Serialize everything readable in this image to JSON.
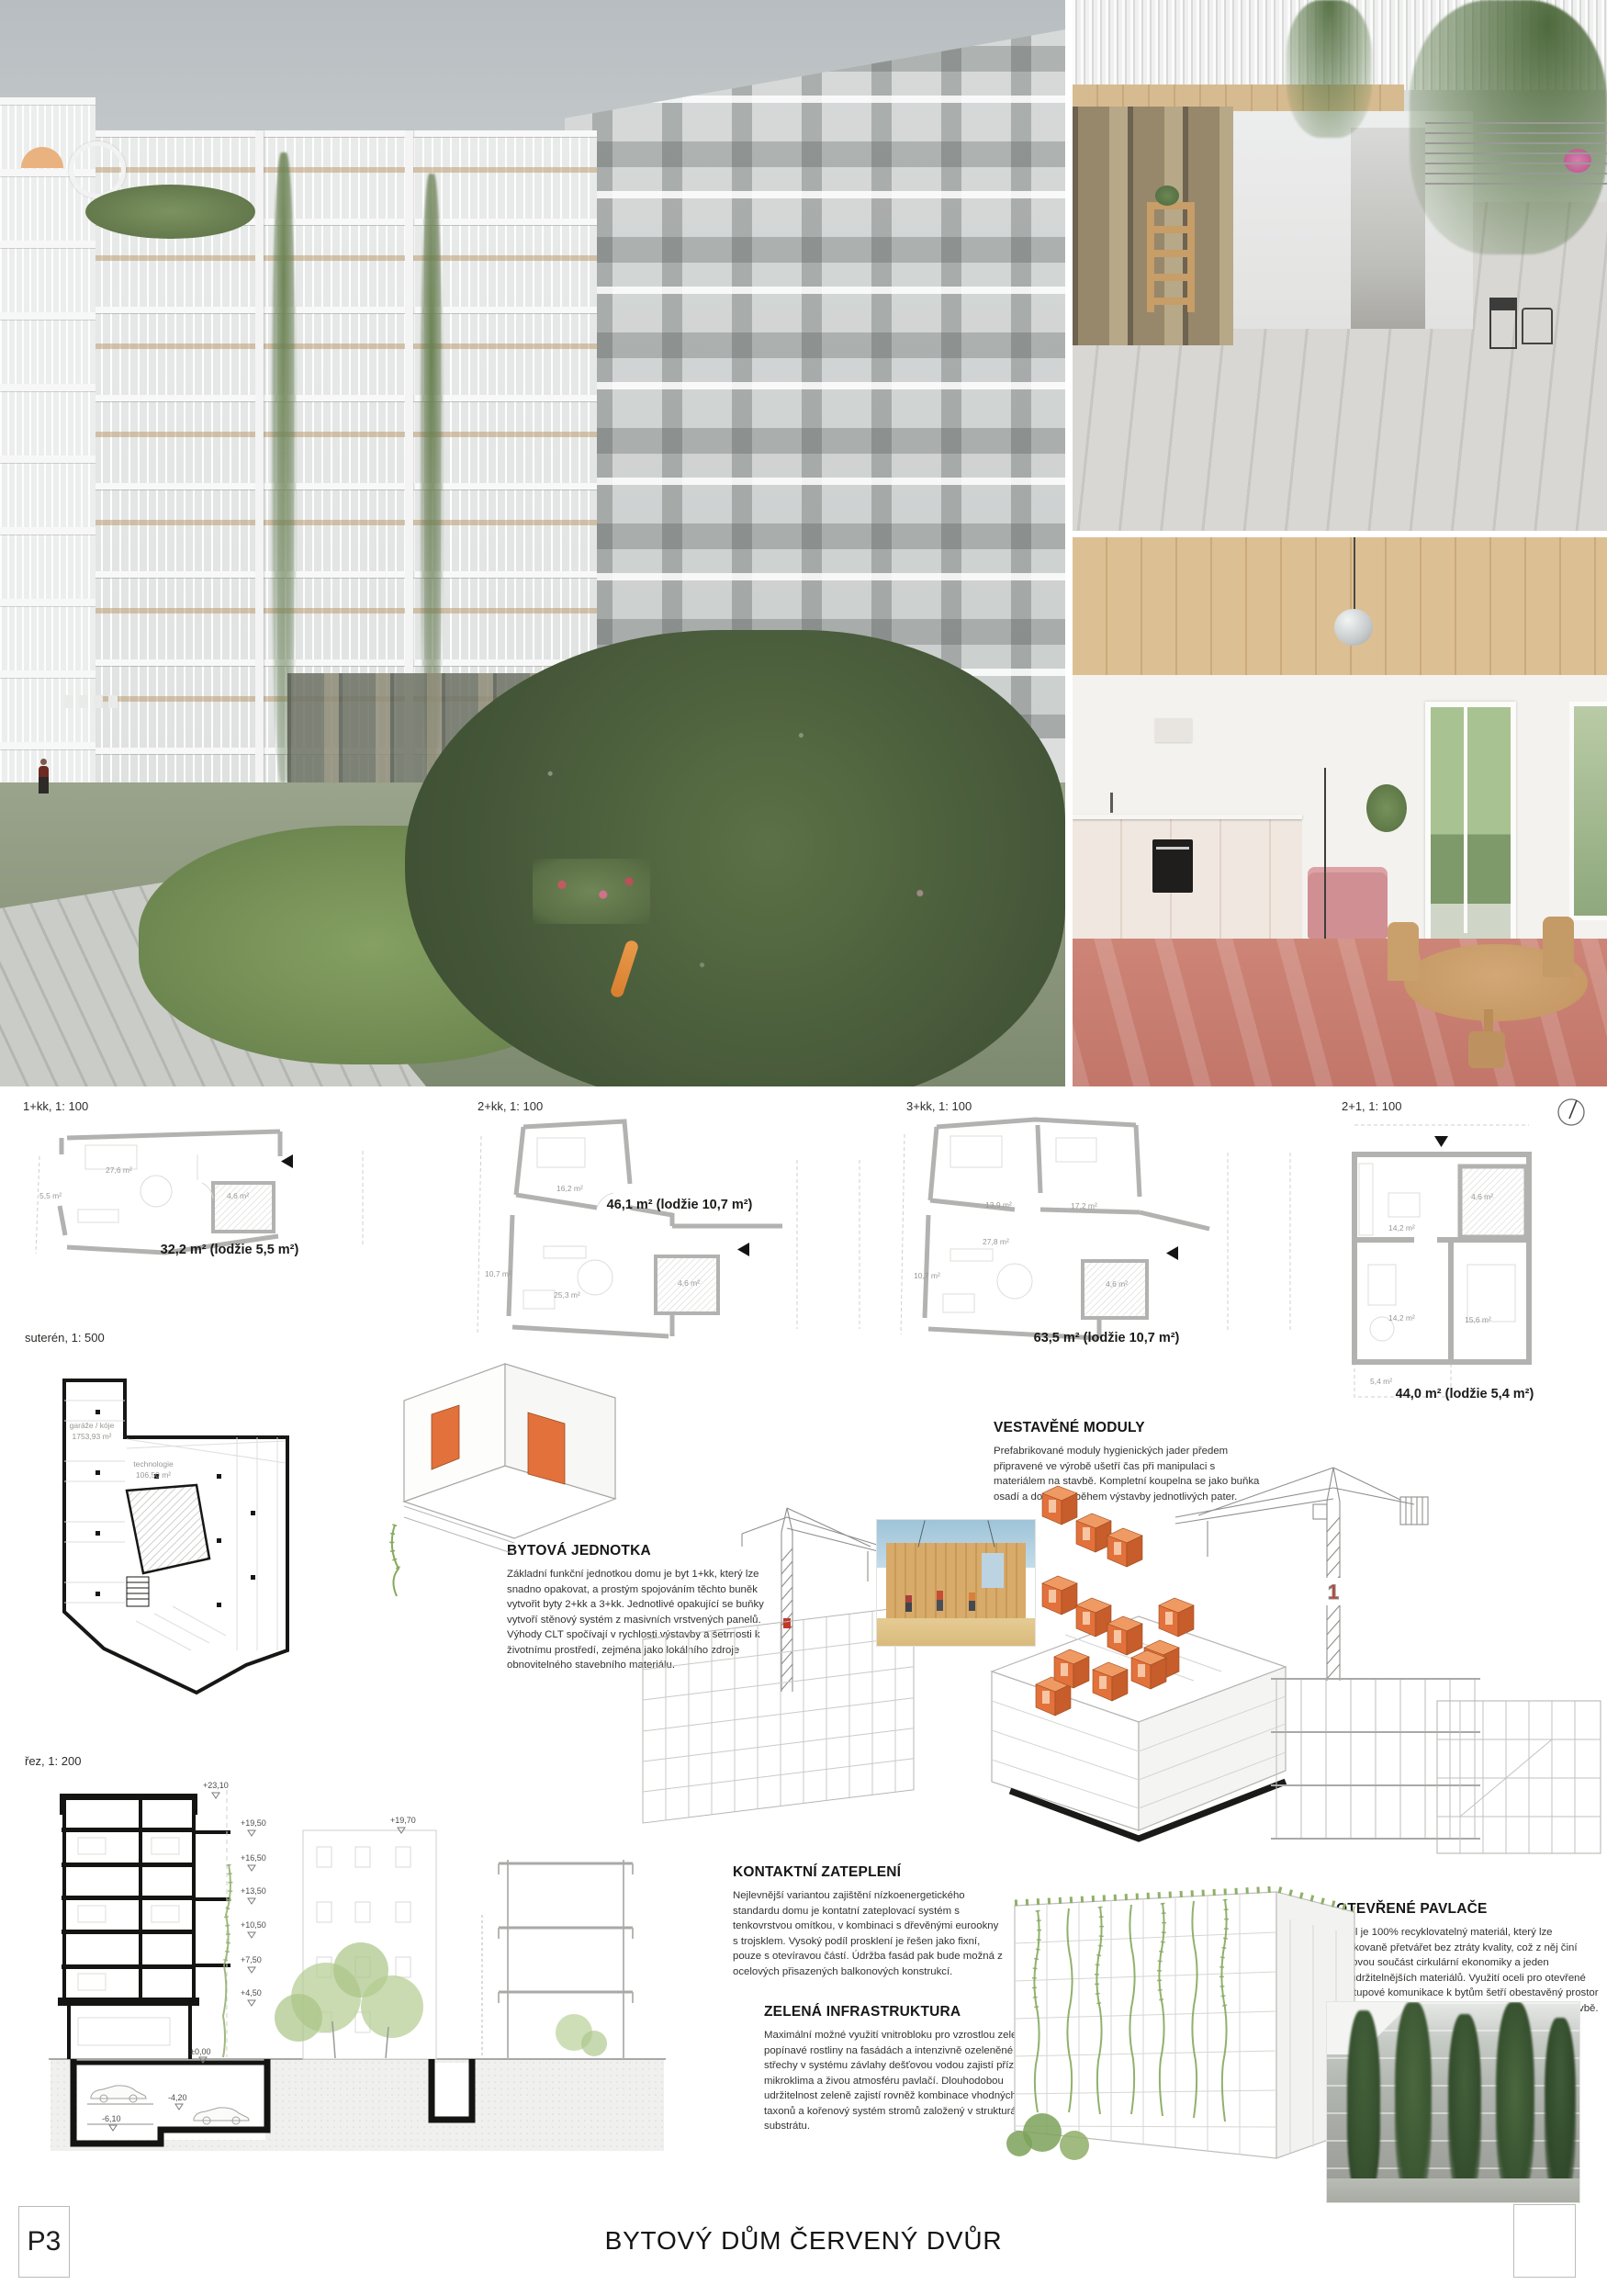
{
  "plans": [
    {
      "label": "1+kk, 1: 100",
      "caption": "32,2 m² (lodžie 5,5 m²)",
      "rooms": [
        "27,6 m²",
        "5,5 m²",
        "4,6 m²"
      ]
    },
    {
      "label": "2+kk, 1: 100",
      "caption": "46,1 m² (lodžie 10,7 m²)",
      "rooms": [
        "16,2 m²",
        "10,7 m²",
        "25,3 m²",
        "4,6 m²"
      ]
    },
    {
      "label": "3+kk, 1: 100",
      "caption": "63,5 m² (lodžie 10,7 m²)",
      "rooms": [
        "13,9 m²",
        "17,2 m²",
        "27,8 m²",
        "10,7 m²",
        "4,6 m²"
      ]
    },
    {
      "label": "2+1, 1: 100",
      "caption": "44,0 m² (lodžie 5,4 m²)",
      "rooms": [
        "14,2 m²",
        "4,6 m²",
        "14,2 m²",
        "15,6 m²",
        "5,4 m²"
      ]
    }
  ],
  "basement": {
    "label": "suterén, 1: 500",
    "garage_name": "garáže / kóje",
    "garage_area": "1753,93 m²",
    "tech_name": "technologie",
    "tech_area": "106,50 m²"
  },
  "section": {
    "label": "řez, 1: 200",
    "top_level": "+23,10",
    "levels": [
      "+19,50",
      "+16,50",
      "+13,50",
      "+10,50",
      "+7,50",
      "+4,50"
    ],
    "neighbor_level": "+19,70",
    "ground": "±0,00",
    "garage_levels": [
      "-4,20",
      "-6,10"
    ]
  },
  "blocks": {
    "bytova_jednotka": {
      "title": "BYTOVÁ JEDNOTKA",
      "body": "Základní funkční jednotkou domu je byt 1+kk, který lze snadno opakovat, a prostým spojováním těchto buněk vytvořit byty 2+kk a 3+kk. Jednotlivé opakující se buňky vytvoří stěnový systém z masivních vrstvených panelů. Výhody CLT spočívají v rychlosti výstavby a šetrnosti k životnímu prostředí, zejména jako lokálního zdroje obnovitelného stavebního materiálu."
    },
    "vestavene_moduly": {
      "title": "VESTAVĚNÉ MODULY",
      "body": "Prefabrikované moduly hygienických jader předem připravené ve výrobě ušetří čas při manipulaci s materiálem na stavbě. Kompletní koupelna se jako buňka osadí a dopojí již během výstavby jednotlivých pater."
    },
    "kontaktni_zatepleni": {
      "title": "KONTAKTNÍ ZATEPLENÍ",
      "body": "Nejlevnější variantou zajištění nízkoenergetického standardu domu je kontatní zateplovací systém s tenkovrstvou omítkou, v kombinaci s dřevěnými eurookny s trojsklem. Vysoký podíl prosklení je řešen jako fixní, pouze s otevíravou částí. Údržba fasád pak bude možná z ocelových přisazených balkonových konstrukcí."
    },
    "zelena_infrastruktura": {
      "title": "ZELENÁ INFRASTRUKTURA",
      "body": "Maximální možné využití vnitrobloku pro vzrostlou zeleň, popínavé rostliny na fasádách a intenzivně ozeleněné střechy v systému závlahy dešťovou vodou zajistí příznivé mikroklima a živou atmosféru pavlačí. Dlouhodobou udržitelnost zeleně zajistí rovněž kombinace vhodných taxonů a kořenový systém stromů založený v strukturálním substrátu."
    },
    "otevrene_pavlace": {
      "title": "OTEVŘENÉ PAVLAČE",
      "body": "Ocel je 100% recyklovatelný materiál, který lze opakovaně přetvářet bez ztráty kvality, což z něj činí klíčovou součást cirkulární ekonomiky a jeden nejudržitelnějších materiálů. Využití oceli pro otevřené přístupové komunikace k bytům šetří obestavěný prostor a omezuje množství využité energie a surovin ve stavbě."
    }
  },
  "crane_badge": "1",
  "footer": {
    "sheet": "P3",
    "title": "BYTOVÝ DŮM ČERVENÝ DVŮR"
  },
  "colors": {
    "accent_orange": "#e2713b",
    "crane_red": "#c0392b"
  }
}
